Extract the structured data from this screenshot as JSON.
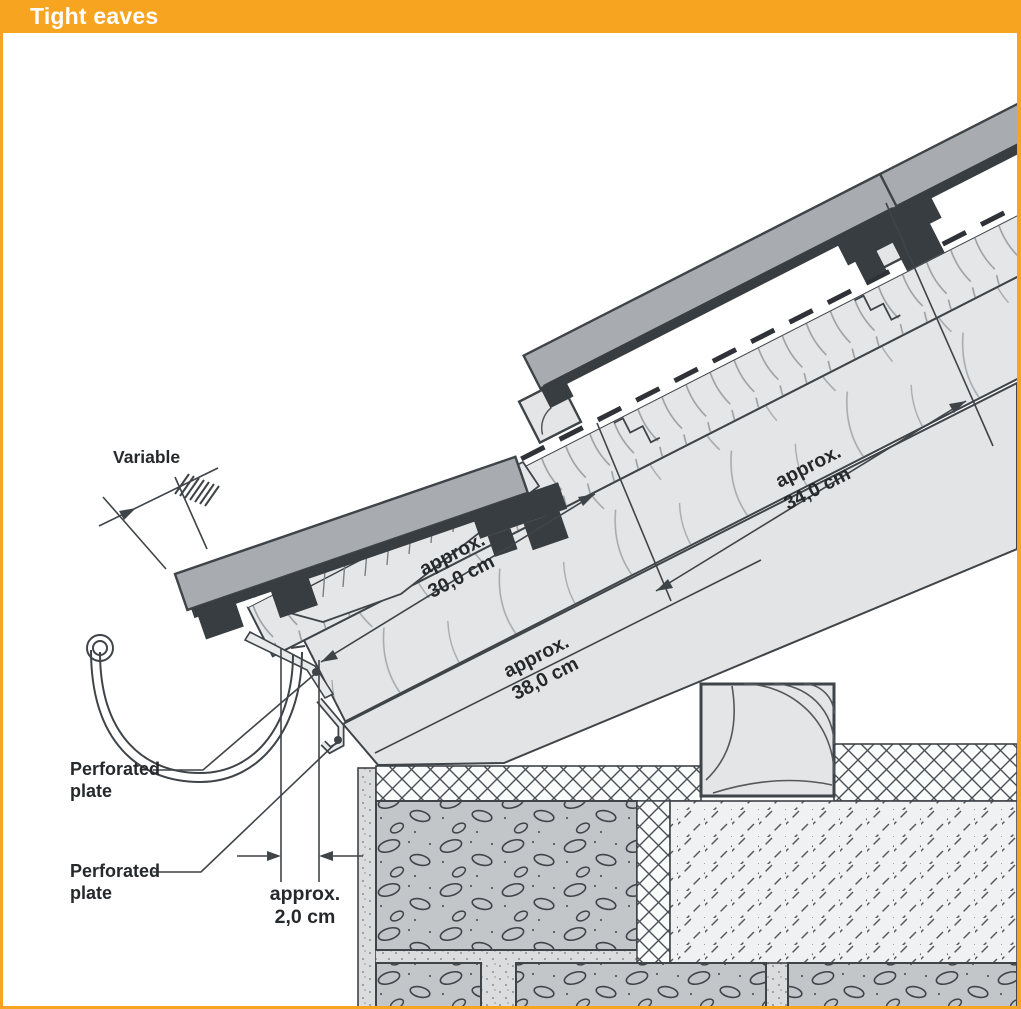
{
  "header": {
    "title": "Tight eaves"
  },
  "frame": {
    "accent_color": "#F7A520"
  },
  "diagram": {
    "labels": {
      "variable": "Variable",
      "perforated_plate_top": {
        "line1": "Perforated",
        "line2": "plate"
      },
      "perforated_plate_bottom": {
        "line1": "Perforated",
        "line2": "plate"
      }
    },
    "dimensions": {
      "tile_gauge": {
        "line1": "approx.",
        "line2": "30,0 cm"
      },
      "batten_spacing": {
        "line1": "approx.",
        "line2": "34,0 cm"
      },
      "rafter_depth": {
        "line1": "approx.",
        "line2": "38,0 cm"
      },
      "vent_gap": {
        "line1": "approx.",
        "line2": "2,0 cm"
      }
    },
    "colors": {
      "tile_gray": "#A8ACB0",
      "tile_dark": "#383D42",
      "wood_light": "#E4E6E7",
      "wall_block": "#C2C6C8",
      "line_dark": "#3F4449"
    }
  }
}
